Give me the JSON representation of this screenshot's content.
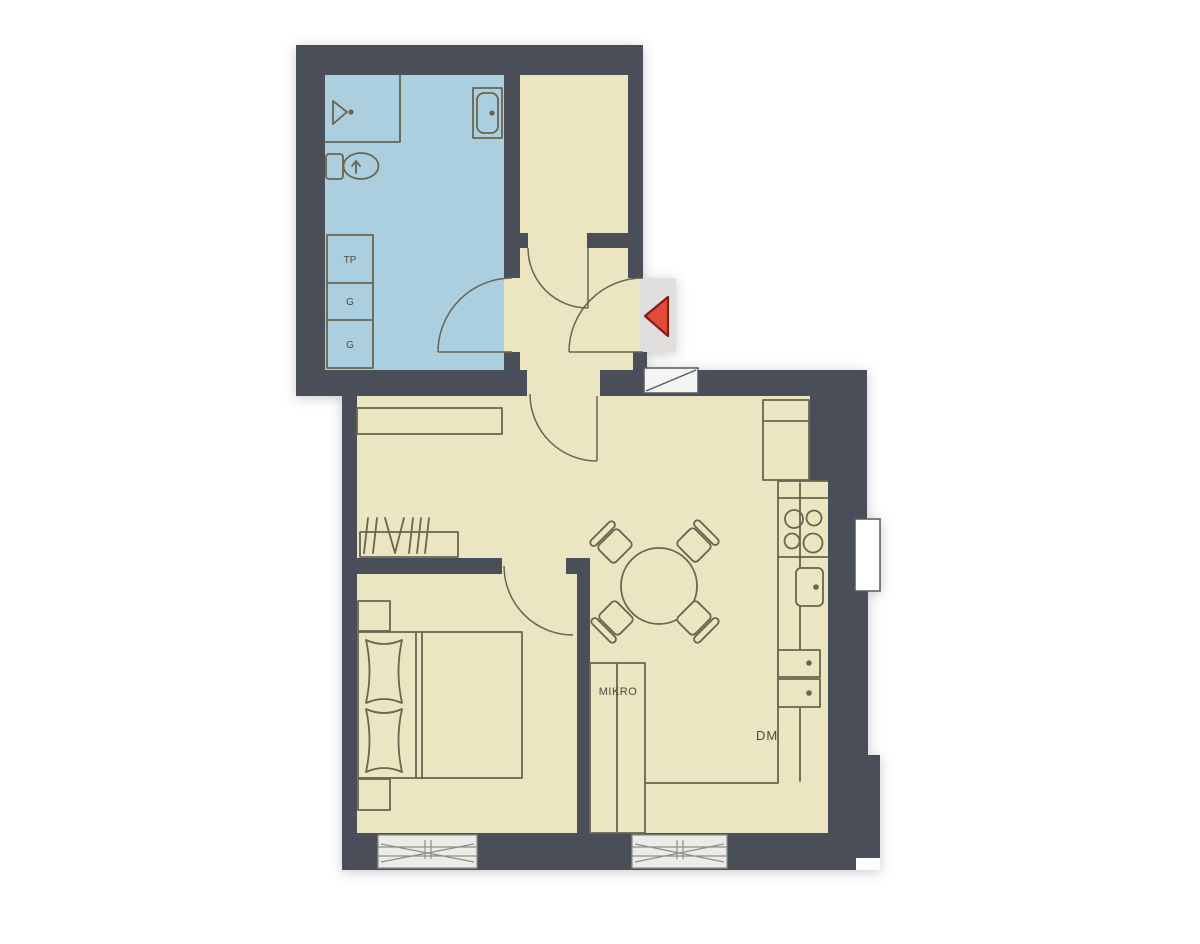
{
  "document": {
    "type": "apartment floor plan",
    "style": "scanned architectural drawing"
  },
  "colors": {
    "wall": "#4a4e58",
    "floor": "#ece5c2",
    "bathroom-floor": "#abcfdf",
    "entry-floor": "#e0dfdd",
    "furniture-line": "#6a6450",
    "entrance-arrow": "#e24b3c",
    "entrance-arrow-outline": "#7e1f15",
    "window-fill": "#ebebe7",
    "window-line": "#8f8f89",
    "shaft-fill": "#f4f4f2",
    "label-text": "#4f4b3e",
    "background": "#ffffff"
  },
  "labels": {
    "washer_column": "TP",
    "wardrobe_cabinet_1": "G",
    "wardrobe_cabinet_2": "G",
    "microwave_cabinet": "MIKRO",
    "dishwasher": "DM"
  }
}
